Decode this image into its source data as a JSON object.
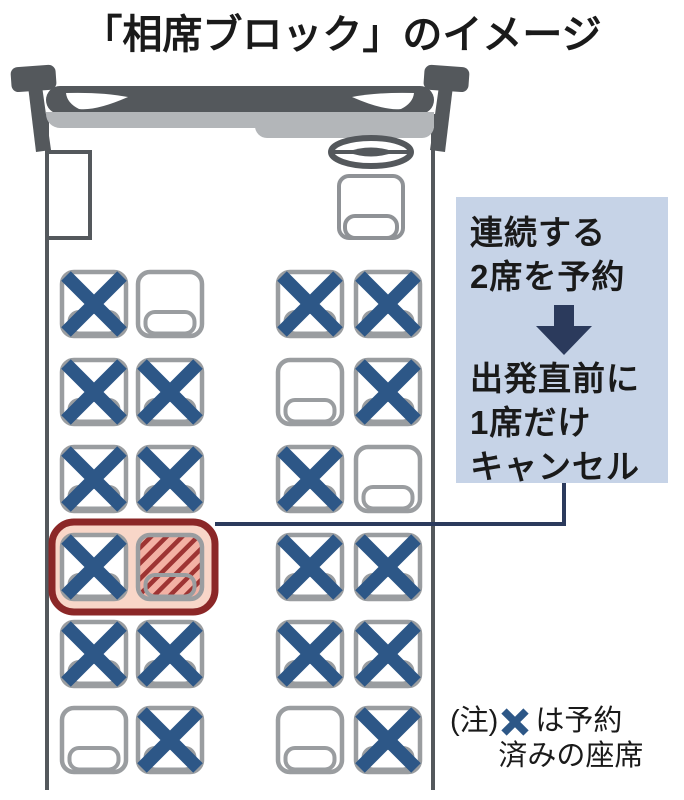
{
  "title": "「相席ブロック」のイメージ",
  "colors": {
    "text": "#1a1a1a",
    "x_blue": "#2d5787",
    "seat_border": "#9a9da0",
    "bus_dark": "#54585c",
    "bus_light": "#b3b6b9",
    "callout_bg": "#c6d3e7",
    "navy": "#2b3a5c",
    "highlight_border": "#8b2727",
    "highlight_fill": "#f8d6c8",
    "hatch_bg": "#f3b1a4",
    "hatch_stripe": "#9e3433"
  },
  "callout": {
    "step1": "連続する\n2席を予約",
    "arrow_icon": "down-arrow",
    "step2": "出発直前に\n1席だけ\nキャンセル"
  },
  "note": {
    "prefix": "(注)",
    "symbol_icon": "booked-x",
    "line1_suffix": "は予約",
    "line2": "済みの座席"
  },
  "seat_map": {
    "statuses": [
      "booked",
      "empty",
      "canceled"
    ],
    "booked_icon": "x-mark",
    "canceled_icon": "red-hatch",
    "rows": [
      {
        "left": [
          "booked",
          "empty"
        ],
        "right": [
          "booked",
          "booked"
        ]
      },
      {
        "left": [
          "booked",
          "booked"
        ],
        "right": [
          "empty",
          "booked"
        ]
      },
      {
        "left": [
          "booked",
          "booked"
        ],
        "right": [
          "booked",
          "empty"
        ]
      },
      {
        "left": [
          "booked",
          "canceled"
        ],
        "right": [
          "booked",
          "booked"
        ],
        "highlighted_pair": "left"
      },
      {
        "left": [
          "booked",
          "booked"
        ],
        "right": [
          "booked",
          "booked"
        ]
      },
      {
        "left": [
          "empty",
          "booked"
        ],
        "right": [
          "empty",
          "booked"
        ]
      }
    ]
  }
}
